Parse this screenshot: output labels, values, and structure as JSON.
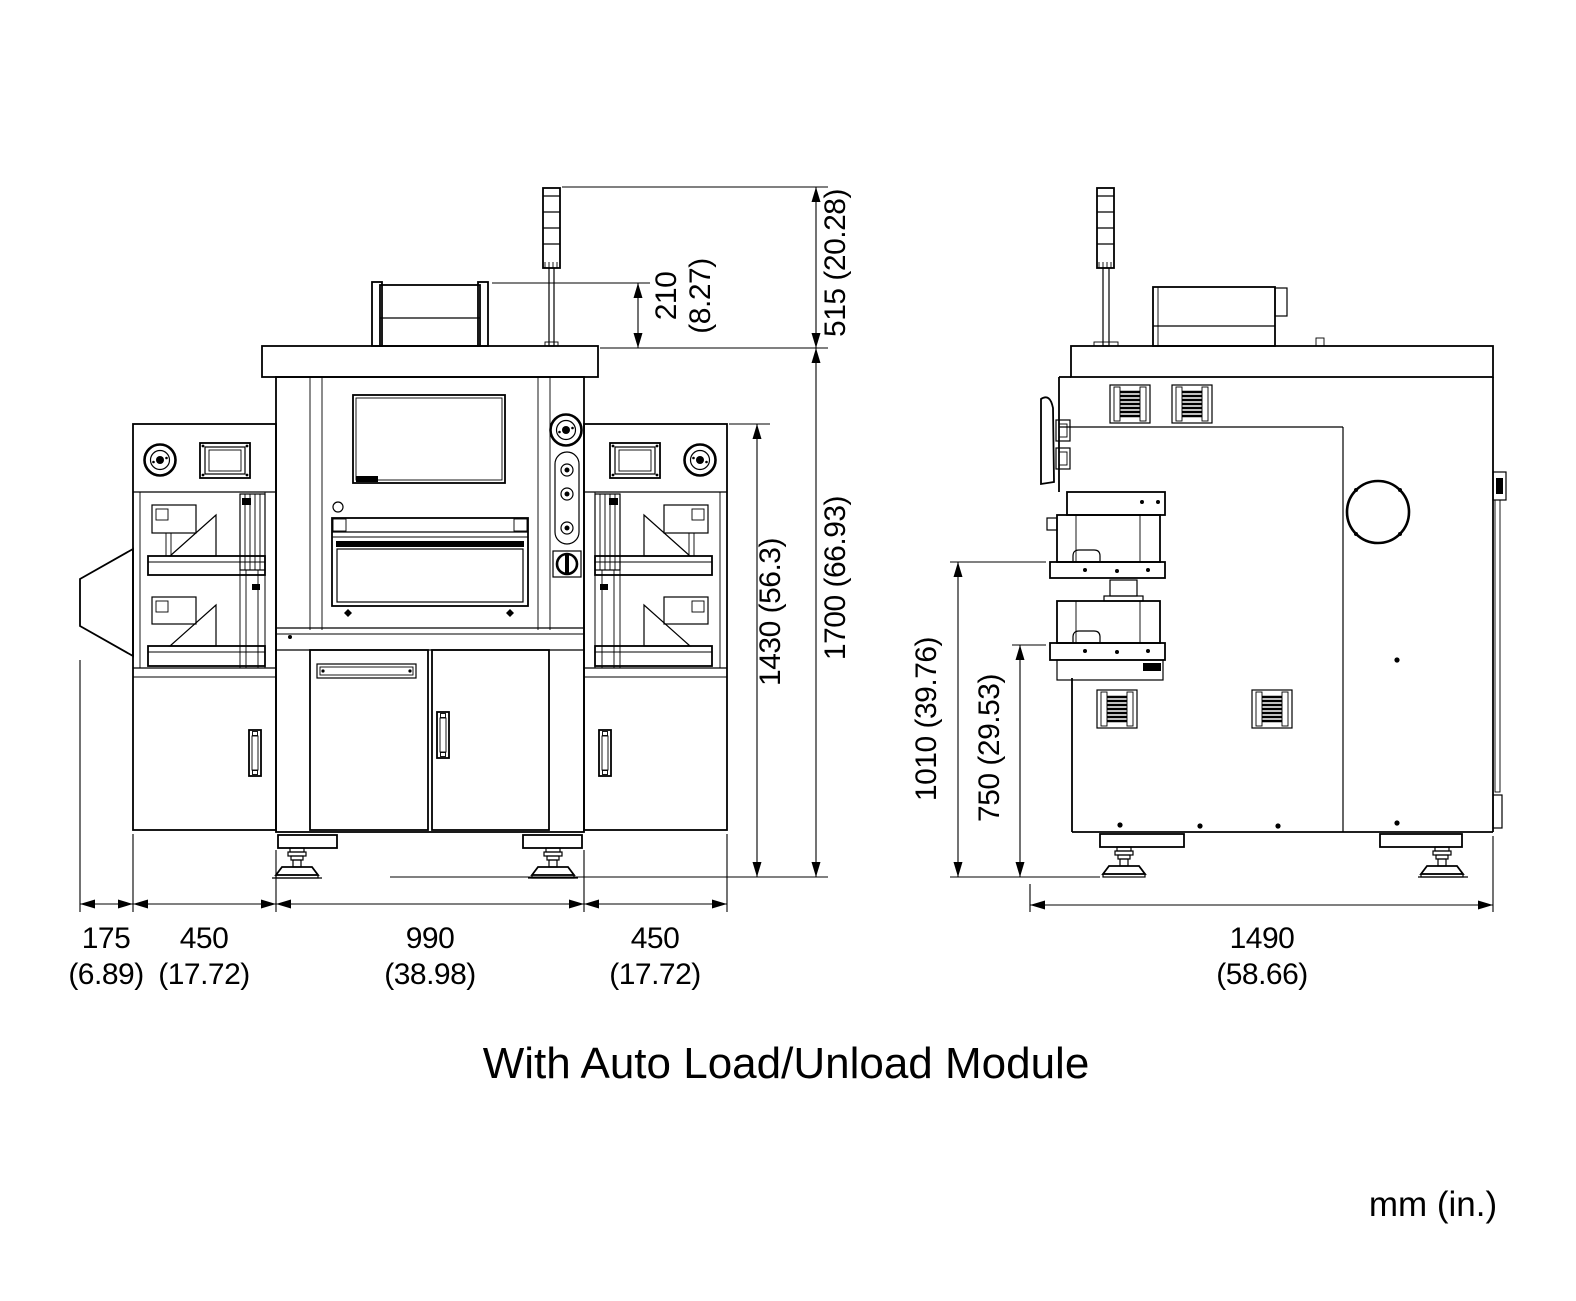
{
  "title_caption": "With Auto Load/Unload Module",
  "units_note": "mm (in.)",
  "dimensions": {
    "front_view": {
      "roof_module_height_mm": "210",
      "roof_module_height_in": "(8.27)",
      "signal_tower_height": "515 (20.28)",
      "frame_height": "1430 (56.3)",
      "overall_height": "1700 (66.93)",
      "width_segments": [
        {
          "mm": "175",
          "in": "(6.89)"
        },
        {
          "mm": "450",
          "in": "(17.72)"
        },
        {
          "mm": "990",
          "in": "(38.98)"
        },
        {
          "mm": "450",
          "in": "(17.72)"
        }
      ]
    },
    "side_view": {
      "upper_stage_height": "1010 (39.76)",
      "lower_stage_height": "750 (29.53)",
      "overall_depth": {
        "mm": "1490",
        "in": "(58.66)"
      }
    }
  }
}
